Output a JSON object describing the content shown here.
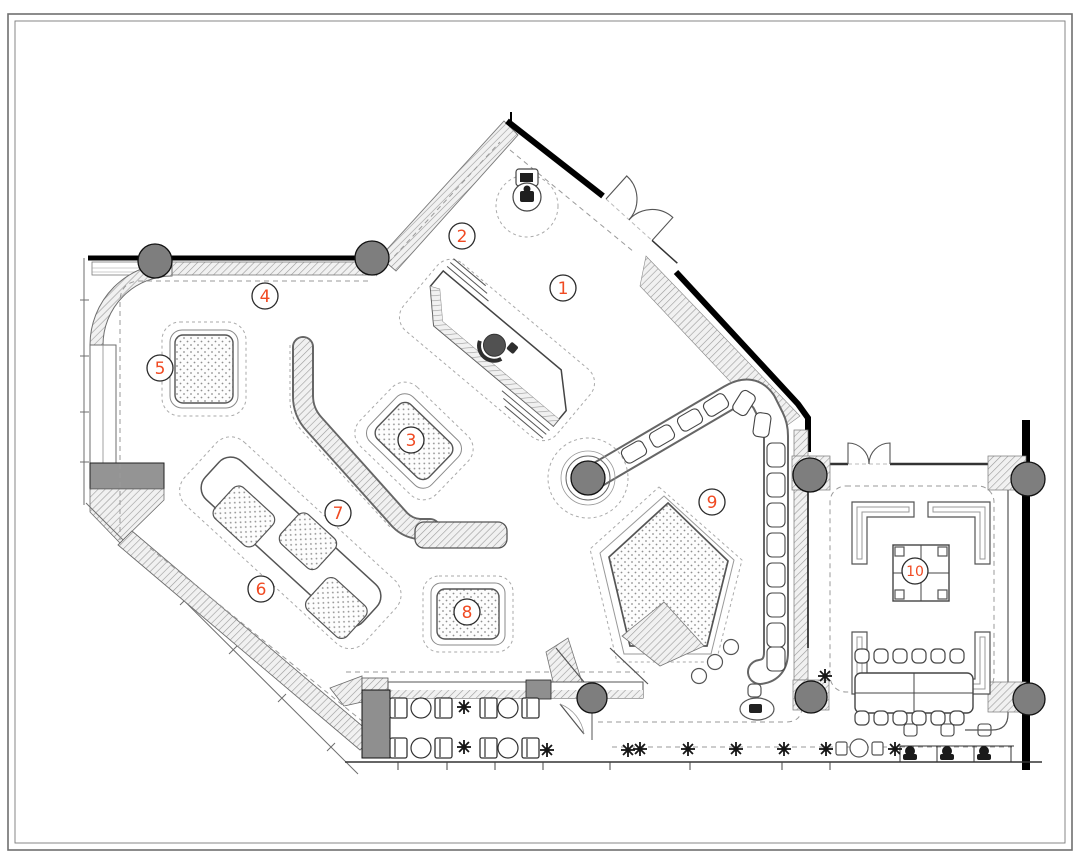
{
  "palette": {
    "accent": "#f04a22",
    "line": "#3c3c3c",
    "column_fill": "#7e7e7e",
    "counter_fill": "#8f8f8f",
    "hatch_line": "#9b9b9b",
    "dot_color": "#8f8f8f"
  },
  "symbols": {
    "column": "filled-circle",
    "plant": "asterisk-burst",
    "door": "quarter-arc-swing"
  },
  "labels": [
    {
      "n": "1",
      "x": 563,
      "y": 288
    },
    {
      "n": "2",
      "x": 462,
      "y": 236
    },
    {
      "n": "3",
      "x": 411,
      "y": 440
    },
    {
      "n": "4",
      "x": 265,
      "y": 296
    },
    {
      "n": "5",
      "x": 160,
      "y": 368
    },
    {
      "n": "6",
      "x": 261,
      "y": 589
    },
    {
      "n": "7",
      "x": 338,
      "y": 513
    },
    {
      "n": "8",
      "x": 467,
      "y": 612
    },
    {
      "n": "9",
      "x": 712,
      "y": 502
    },
    {
      "n": "10",
      "x": 915,
      "y": 571
    }
  ],
  "columns": [
    {
      "x": 155,
      "y": 261,
      "r": 17
    },
    {
      "x": 372,
      "y": 258,
      "r": 17
    },
    {
      "x": 588,
      "y": 478,
      "r": 17
    },
    {
      "x": 592,
      "y": 698,
      "r": 15
    },
    {
      "x": 810,
      "y": 475,
      "r": 17
    },
    {
      "x": 1028,
      "y": 479,
      "r": 17
    },
    {
      "x": 811,
      "y": 697,
      "r": 16
    },
    {
      "x": 1029,
      "y": 699,
      "r": 16
    }
  ],
  "plants": {
    "points": [
      [
        464,
        707
      ],
      [
        464,
        747
      ],
      [
        547,
        750
      ],
      [
        628,
        750
      ],
      [
        825,
        676
      ],
      [
        640,
        749
      ],
      [
        688,
        749
      ],
      [
        736,
        749
      ],
      [
        784,
        749
      ],
      [
        826,
        749
      ],
      [
        895,
        749
      ]
    ]
  },
  "cafe": {
    "chair_xs": [
      390,
      435,
      480,
      522
    ],
    "table_xs": [
      421,
      508
    ],
    "row_ys": [
      698,
      738
    ]
  },
  "conference": {
    "stool_xs": [
      862,
      881,
      900,
      919,
      938,
      957
    ],
    "top_y": 656,
    "bottom_y": 718
  },
  "counter_seats": {
    "diag": [
      [
        634,
        452,
        -30
      ],
      [
        662,
        436,
        -30
      ],
      [
        690,
        420,
        -30
      ],
      [
        716,
        405,
        -32
      ],
      [
        744,
        403,
        -58
      ],
      [
        762,
        425,
        -82
      ]
    ],
    "vert_x": 776,
    "vert_ys": [
      455,
      485,
      515,
      545,
      575,
      605,
      635,
      659
    ]
  },
  "desks": {
    "xs": [
      910,
      947,
      984
    ]
  }
}
